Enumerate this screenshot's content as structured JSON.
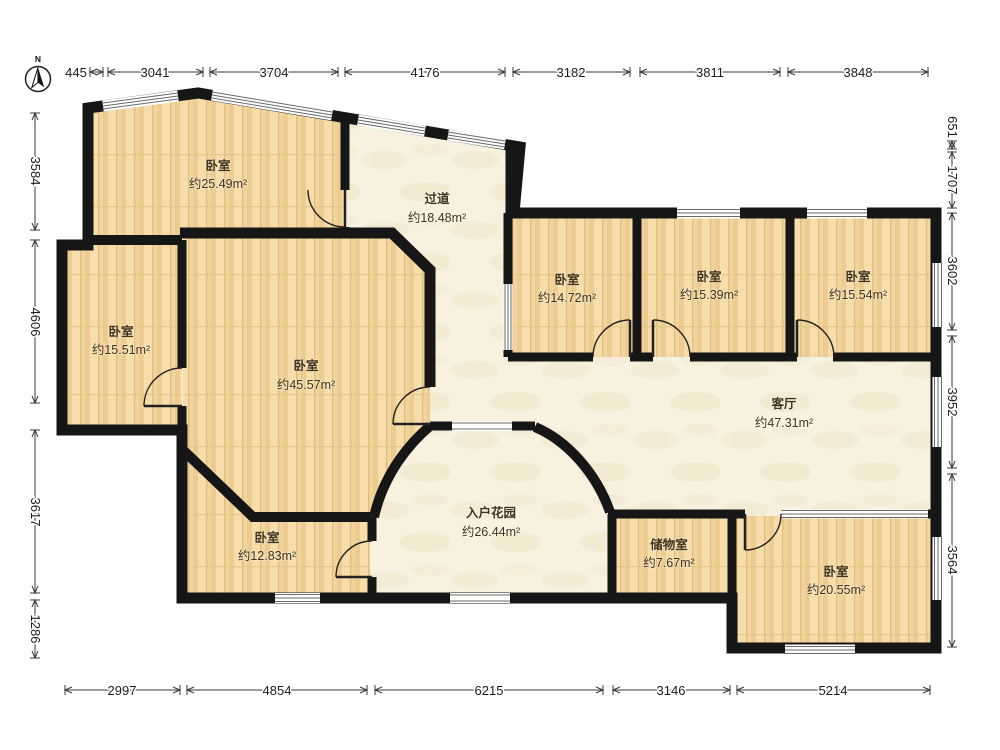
{
  "compass": {
    "label": "N"
  },
  "rooms": [
    {
      "name": "卧室",
      "area": "约25.49m²"
    },
    {
      "name": "过道",
      "area": "约18.48m²"
    },
    {
      "name": "卧室",
      "area": "约14.72m²"
    },
    {
      "name": "卧室",
      "area": "约15.39m²"
    },
    {
      "name": "卧室",
      "area": "约15.54m²"
    },
    {
      "name": "卧室",
      "area": "约15.51m²"
    },
    {
      "name": "卧室",
      "area": "约45.57m²"
    },
    {
      "name": "客厅",
      "area": "约47.31m²"
    },
    {
      "name": "卧室",
      "area": "约12.83m²"
    },
    {
      "name": "入户花园",
      "area": "约26.44m²"
    },
    {
      "name": "储物室",
      "area": "约7.67m²"
    },
    {
      "name": "卧室",
      "area": "约20.55m²"
    }
  ],
  "dimensions": {
    "top": [
      "445",
      "3041",
      "3704",
      "4176",
      "3182",
      "3811",
      "3848"
    ],
    "left": [
      "3584",
      "4606",
      "3617",
      "1286"
    ],
    "right": [
      "651",
      "1707",
      "3602",
      "3952",
      "3564"
    ],
    "bottom": [
      "2997",
      "4854",
      "6215",
      "3146",
      "5214"
    ]
  },
  "colors": {
    "wall": "#161616",
    "wood_floor": "#f2d49d",
    "tile_floor": "#f8f1df"
  }
}
